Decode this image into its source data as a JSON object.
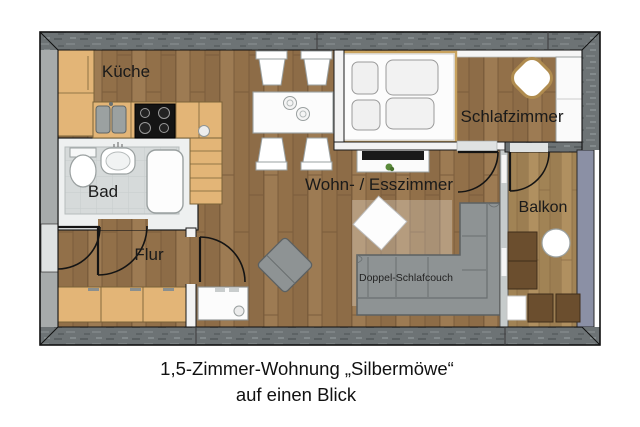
{
  "floorplan": {
    "labels": {
      "kitchen": "Küche",
      "bedroom": "Schlafzimmer",
      "bathroom": "Bad",
      "hallway": "Flur",
      "living_dining": "Wohn- / Esszimmer",
      "balcony": "Balkon",
      "sofa": "Doppel-Schlafcouch"
    },
    "caption": {
      "line1": "1,5-Zimmer-Wohnung „Silbermöwe“",
      "line2": "auf einen Blick"
    },
    "colors": {
      "wood_floor": "#97754e",
      "balcony_floor": "#a8885c",
      "cabinet_wood": "#e3b577",
      "outer_wall": "#6d7375",
      "side_wall": "#a7abab",
      "bath_floor": "#d6dada",
      "sofa_gray": "#8e9394",
      "balcony_railing": "#8b90a5",
      "balcony_furniture": "#6b4e2e",
      "bed_trim": "#c9a35f",
      "background": "#ffffff"
    }
  }
}
